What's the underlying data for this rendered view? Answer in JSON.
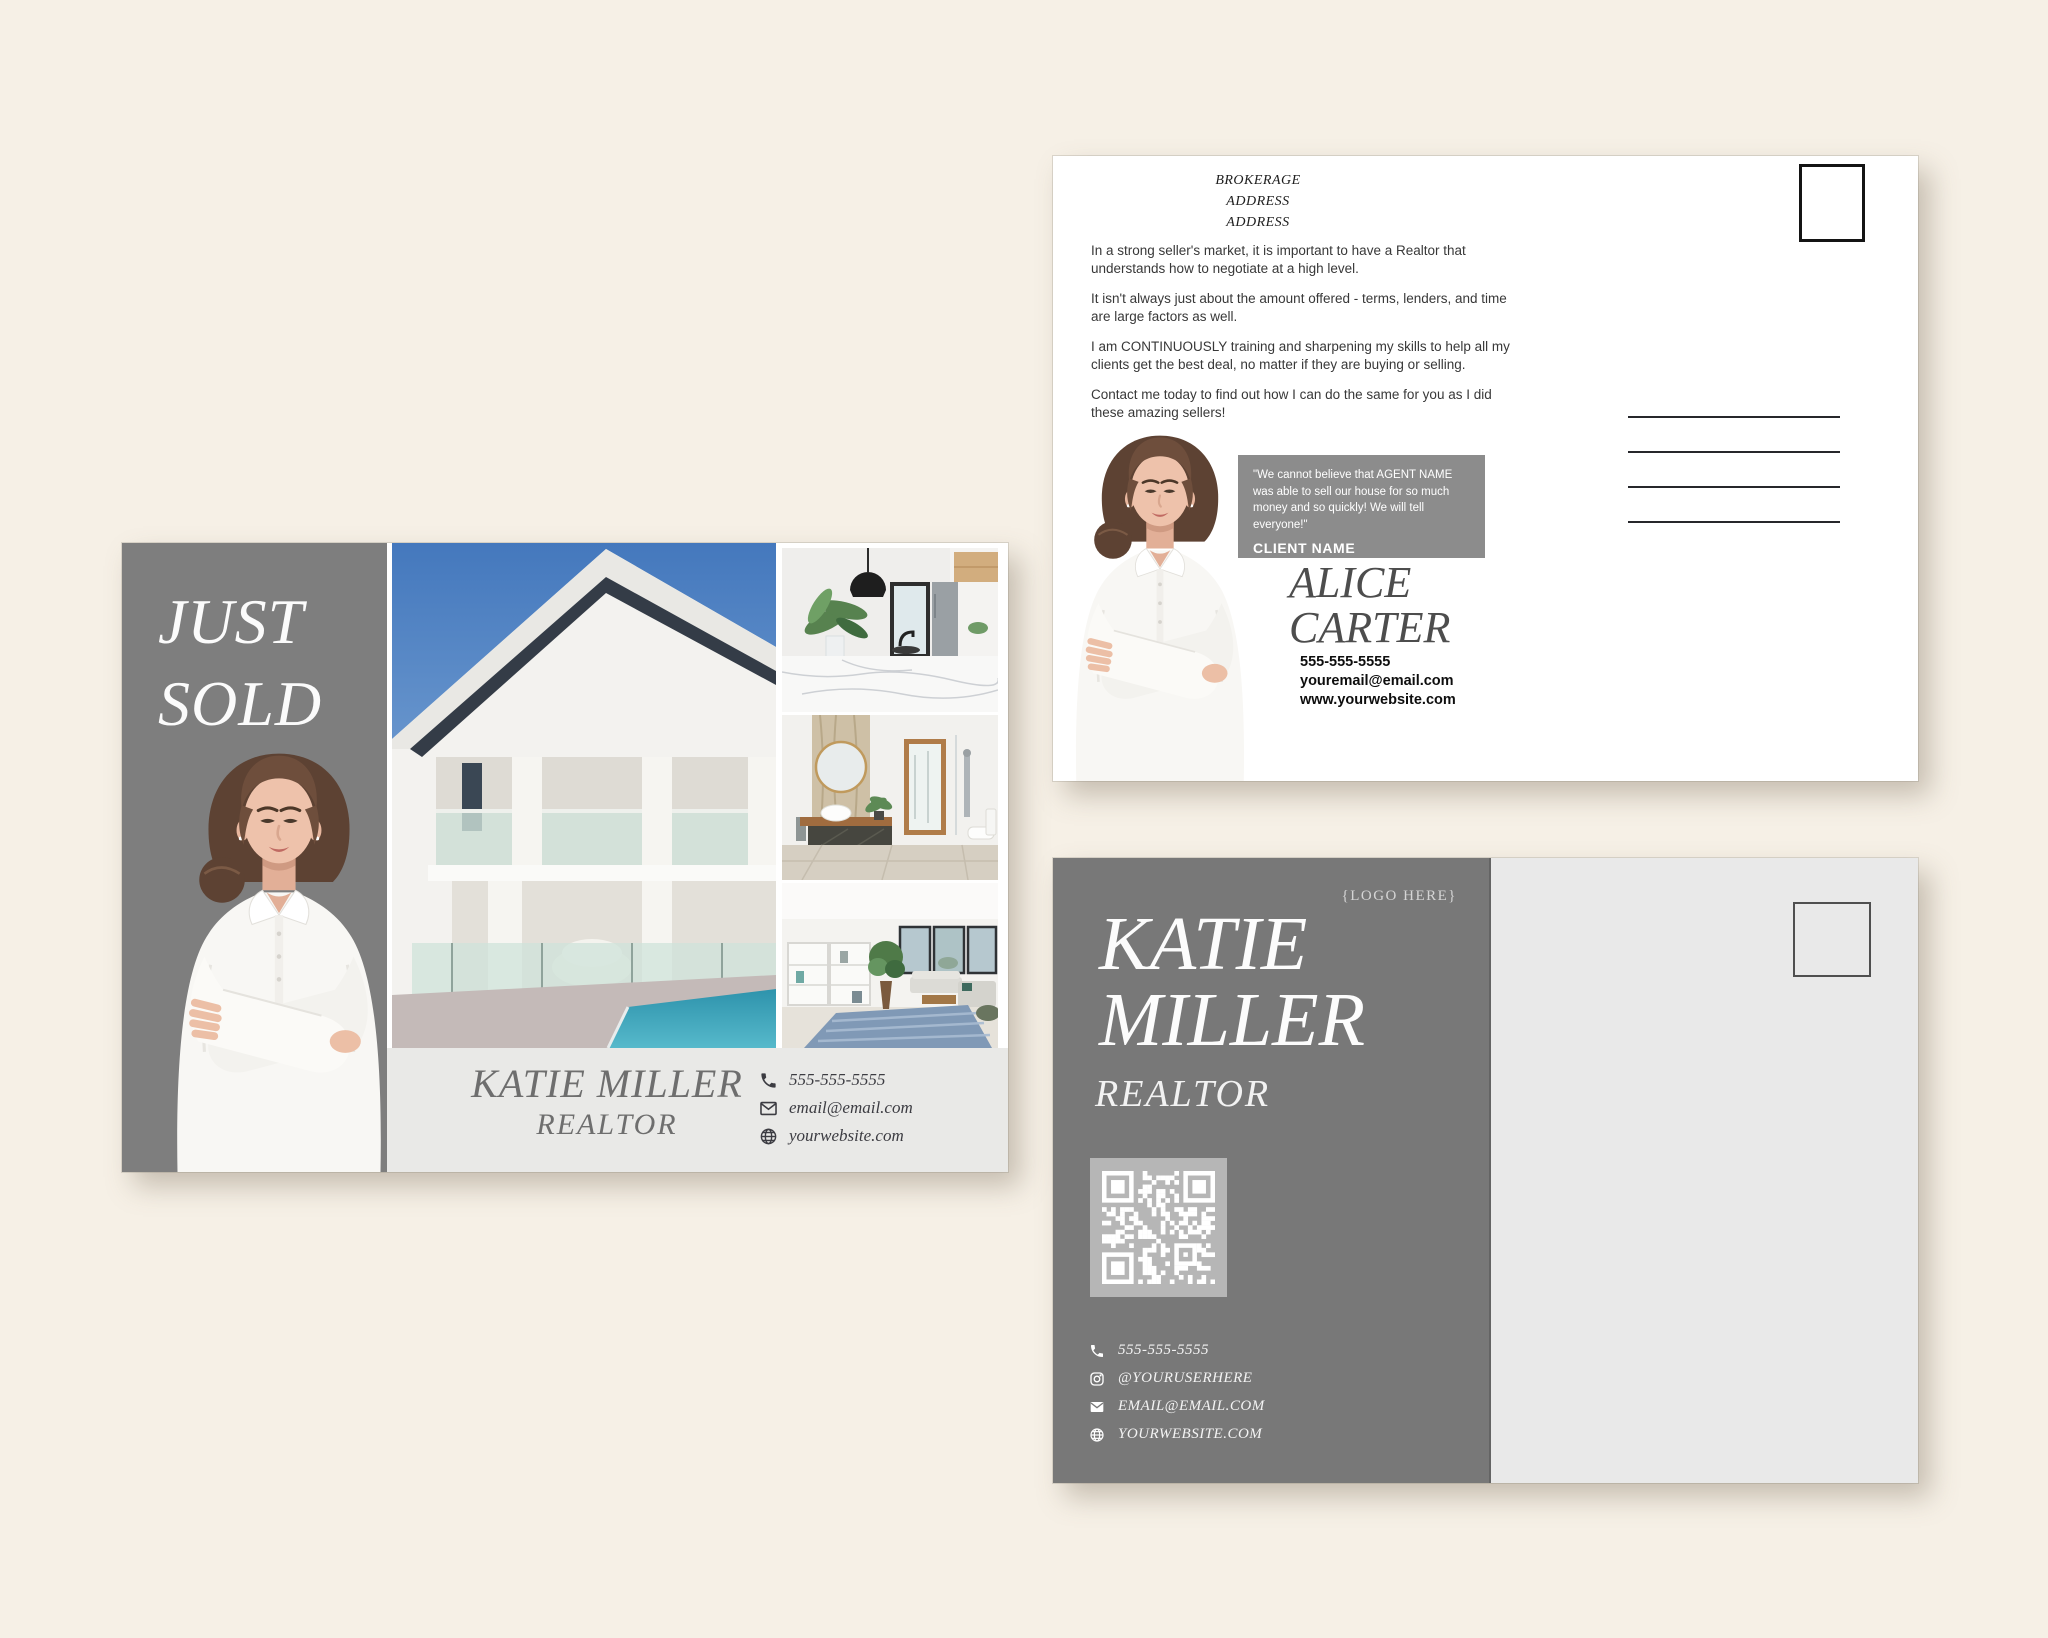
{
  "front_card": {
    "headline": [
      "JUST",
      "SOLD"
    ],
    "agent_name": "KATIE MILLER",
    "agent_title": "REALTOR",
    "phone": "555-555-5555",
    "email": "email@email.com",
    "website": "yourwebsite.com"
  },
  "back_card": {
    "brokerage": [
      "BROKERAGE",
      "ADDRESS",
      "ADDRESS"
    ],
    "paragraphs": [
      "In a strong seller's market, it is important to have a Realtor that understands how to negotiate at a high level.",
      "It isn't always just about the amount offered - terms, lenders, and time are large factors as well.",
      "I am CONTINUOUSLY training and sharpening my skills to help all my clients get the best deal, no matter if they are buying or selling.",
      "Contact me today to find out how I can do the same for you as I did these amazing sellers!"
    ],
    "testimonial_quote": "\"We cannot believe that AGENT NAME was able to sell our house for so much money and so quickly! We will tell everyone!\"",
    "testimonial_client": "CLIENT NAME",
    "agent_first_name": "ALICE",
    "agent_last_name": "CARTER",
    "phone": "555-555-5555",
    "email": "youremail@email.com",
    "website": "www.yourwebsite.com"
  },
  "branding_card": {
    "logo_placeholder": "{LOGO HERE}",
    "name": [
      "KATIE",
      "MILLER"
    ],
    "title": "REALTOR",
    "phone": "555-555-5555",
    "instagram": "@YOURUSERHERE",
    "email": "EMAIL@EMAIL.COM",
    "website": "YOURWEBSITE.COM"
  },
  "colors": {
    "background": "#f6f0e6",
    "panel_gray": "#7e7e7e",
    "bar_light": "#e9e9e7",
    "testimonial_gray": "#8c8c8c",
    "qr_tile": "#b6b6b6"
  }
}
